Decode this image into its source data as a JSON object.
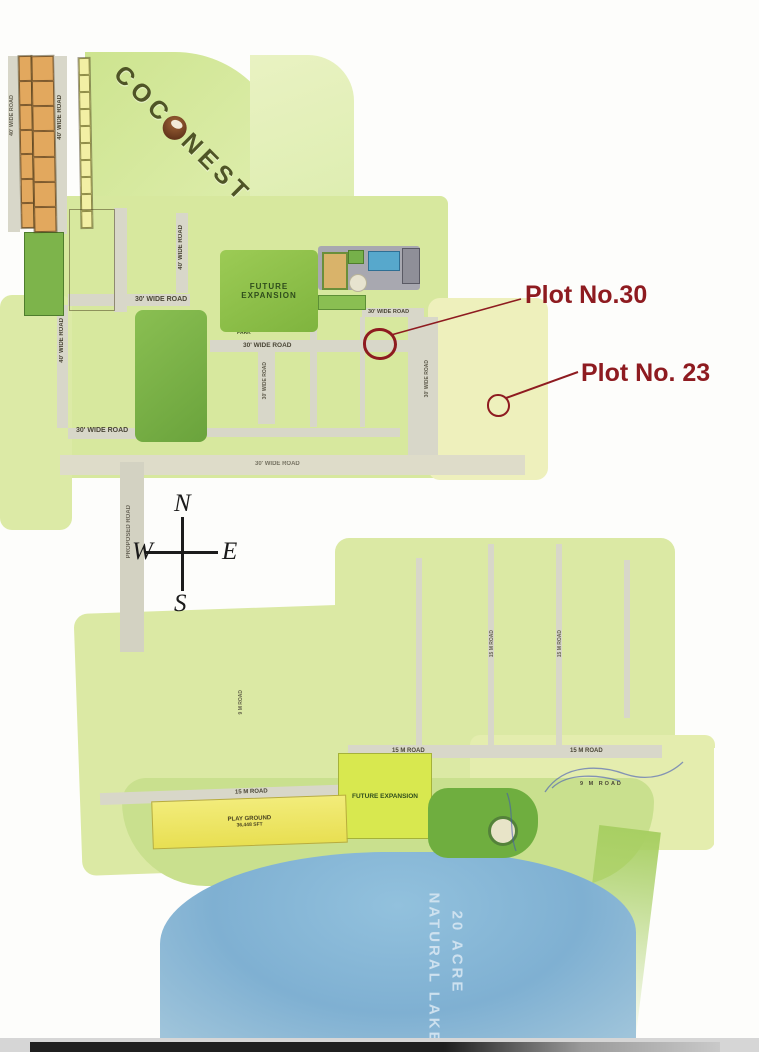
{
  "brand": {
    "prefix": "COC",
    "suffix": "NEST",
    "full_name": "COCONEST"
  },
  "annotations": {
    "plot30": "Plot No.30",
    "plot23": "Plot No. 23",
    "color": "#8e1b20",
    "circled_plots": [
      "30",
      "23"
    ]
  },
  "compass": {
    "n": "N",
    "w": "W",
    "e": "E",
    "s": "S"
  },
  "lake": {
    "line1": "20 ACRE",
    "line2": "NATURAL LAKE"
  },
  "labels": {
    "future_expansion": "FUTURE EXPANSION",
    "park_area": "PARK AREA",
    "park": "PARK",
    "playground": "PLAY GROUND",
    "playground_area": "36,448 SFT",
    "road_40": "40' WIDE ROAD",
    "road_30": "30' WIDE ROAD",
    "road_proposed": "PROPOSED ROAD",
    "road_15m": "15 M ROAD",
    "road_9m": "9 M ROAD"
  },
  "colors": {
    "annotation": "#8e1b20",
    "lake": "#84b6d6",
    "plot_tan": "#e2a85e",
    "plot_pink": "#edc3de",
    "plot_yellow": "#f2efa4",
    "road": "#d8d7c9",
    "lawn": "#cfe492",
    "brand_text": "#4f5426"
  },
  "clusters": {
    "strip_a": {
      "type": "cols",
      "cols": [
        {
          "count": 7
        }
      ],
      "color": "tan"
    },
    "strip_b": {
      "type": "cols",
      "cols": [
        {
          "count": 7
        }
      ],
      "color": "tan"
    },
    "strip_c": {
      "type": "cols",
      "cols": [
        {
          "count": 10
        }
      ],
      "color": "yellow"
    },
    "pink_top_a": {
      "type": "rows",
      "color": "pink",
      "rows": [
        [
          "06",
          "07",
          "08",
          "09"
        ],
        [
          "05",
          "10"
        ],
        [
          "04",
          "11"
        ],
        [
          "03",
          "12"
        ],
        [
          "02",
          "13"
        ],
        [
          "01",
          "14"
        ]
      ]
    },
    "pink_top_b": {
      "type": "rows",
      "color": "pink",
      "rows": [
        [
          "20",
          "21",
          "22",
          "23"
        ],
        [
          "19",
          "24"
        ],
        [
          "18",
          "25"
        ],
        [
          "17",
          "26"
        ],
        [
          "15",
          "16",
          "27",
          "28"
        ]
      ]
    },
    "orange_strip": {
      "type": "rows",
      "color": "tan",
      "rows": [
        [
          "26",
          "27"
        ],
        [
          "25",
          "28"
        ],
        [
          "24",
          "29"
        ],
        [
          "23",
          "30"
        ],
        [
          "22",
          "31"
        ],
        [
          "21",
          "32"
        ],
        [
          "20",
          "33"
        ],
        [
          "19",
          "34"
        ]
      ]
    },
    "orange_a": {
      "type": "rows",
      "color": "tan",
      "rows": [
        [
          "1",
          "6"
        ],
        [
          "2",
          "7"
        ],
        [
          "3",
          "8"
        ],
        [
          "4",
          "5"
        ]
      ]
    },
    "orange_b": {
      "type": "rows",
      "color": "tan",
      "rows": [
        [
          "9",
          "16"
        ],
        [
          "10",
          "15"
        ],
        [
          "11",
          "14"
        ],
        [
          "12",
          "13"
        ]
      ]
    },
    "orange_c": {
      "type": "rows",
      "color": "tan",
      "rows": [
        [
          "17",
          "28"
        ],
        [
          "18",
          "27"
        ],
        [
          "19",
          "26"
        ],
        [
          "20",
          "25"
        ],
        [
          "21",
          "24"
        ],
        [
          "22",
          "23"
        ]
      ]
    },
    "orange_d": {
      "type": "rows",
      "color": "tan",
      "rows": [
        [
          "29",
          "40"
        ],
        [
          "30",
          "39"
        ],
        [
          "31",
          "38"
        ],
        [
          "32",
          "37"
        ],
        [
          "33",
          "36"
        ],
        [
          "34",
          "35"
        ]
      ]
    },
    "orange_top": {
      "type": "rows",
      "color": "tan",
      "rows": [
        [
          "41",
          "42",
          "43"
        ]
      ]
    },
    "orange_bottom": {
      "type": "rows",
      "color": "tan",
      "rows": [
        [
          "60",
          "59",
          "58",
          "57",
          "56",
          "55",
          "54",
          "53",
          "52",
          "51"
        ]
      ]
    },
    "yellow_strip": {
      "type": "cols",
      "color": "yellow",
      "cols": [
        [
          "44",
          "45",
          "46",
          "47",
          "48",
          "49"
        ]
      ]
    },
    "pink_east": {
      "type": "rows",
      "color": "pink",
      "rows": [
        [
          "16",
          "19"
        ],
        [
          "17",
          "20"
        ],
        [
          "18",
          "21"
        ],
        [
          "15",
          "22"
        ],
        [
          "14",
          "23"
        ],
        [
          "13",
          "24"
        ],
        [
          "12",
          "25"
        ],
        [
          "11",
          "26"
        ]
      ]
    },
    "mid_tail": {
      "type": "cols",
      "color": "yellow",
      "cols": [
        {
          "from": 422,
          "to": 428
        },
        {
          "from": 443,
          "to": 437
        }
      ]
    },
    "mid_w": {
      "type": "cols",
      "color": "yellow",
      "cols": [
        {
          "from": 565,
          "to": 575
        },
        {
          "from": 444,
          "to": 454
        }
      ]
    },
    "mid_c": {
      "type": "cols",
      "color": "yellow",
      "cols": [
        {
          "from": 477,
          "to": 463
        },
        {
          "from": 478,
          "to": 492
        }
      ]
    },
    "mid_e": {
      "type": "cols",
      "color": "yellow",
      "cols": [
        {
          "from": 509,
          "to": 495
        },
        {
          "from": 510,
          "to": 524
        }
      ]
    },
    "mid_far": {
      "type": "cols",
      "color": "yellow",
      "cols": [
        {
          "from": 525,
          "to": 533
        }
      ]
    },
    "south_west": {
      "type": "cols",
      "color": "yellow",
      "cols": [
        {
          "from": 300,
          "to": 306
        },
        {
          "from": 318,
          "to": 307
        },
        {
          "from": 319,
          "to": 331
        },
        {
          "from": 344,
          "to": 332
        },
        {
          "from": 345,
          "to": 355
        },
        {
          "from": 365,
          "to": 356
        },
        {
          "from": 366,
          "to": 377
        },
        {
          "from": 387,
          "to": 378
        },
        {
          "from": 388,
          "to": 395
        }
      ]
    },
    "south_east": {
      "type": "rows",
      "color": "yellow",
      "rows": [
        {
          "from": 534,
          "to": 540
        },
        {
          "from": 551,
          "to": 541
        },
        {
          "from": 552,
          "to": 560
        }
      ]
    }
  }
}
